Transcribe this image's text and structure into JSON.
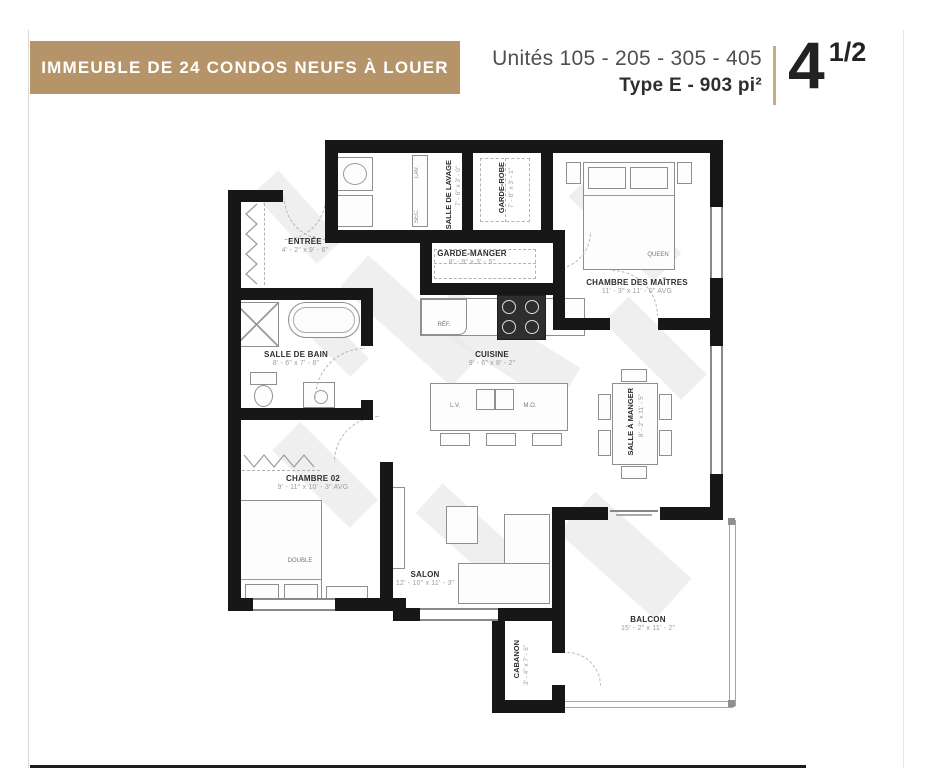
{
  "header": {
    "banner": "IMMEUBLE DE 24 CONDOS NEUFS À LOUER",
    "units_line": "Unités 105 - 205 - 305 - 405",
    "type_line": "Type E - 903 pi²",
    "size_main": "4",
    "size_fraction": "1/2",
    "banner_color": "#b5946a",
    "divider_color": "#c9ab80"
  },
  "rooms": {
    "entree": {
      "name": "ENTRÉE",
      "dims": "4' - 2\" x 9' - 6\""
    },
    "salle_de_lavage": {
      "name": "SALLE DE LAVAGE",
      "dims": "7' - 6\" x 3' - 0\""
    },
    "garde_robe": {
      "name": "GARDE-ROBE",
      "dims": "7' - 8\" x 3' - 1\""
    },
    "garde_manger": {
      "name": "GARDE-MANGER",
      "dims": "8' - 9\" x 3' - 5\""
    },
    "chambre_maitres": {
      "name": "CHAMBRE DES MAÎTRES",
      "dims": "11' - 3\" x 11' - 0\" AVG"
    },
    "salle_de_bain": {
      "name": "SALLE DE BAIN",
      "dims": "8' - 6\" x 7' - 8\""
    },
    "cuisine": {
      "name": "CUISINE",
      "dims": "9' - 6\" x 8' - 2\""
    },
    "salle_a_manger": {
      "name": "SALLE À MANGER",
      "dims": "8' - 2\" x 11' - 5\""
    },
    "chambre02": {
      "name": "CHAMBRE 02",
      "dims": "9' - 11\" x 10' - 3\" AVG"
    },
    "salon": {
      "name": "SALON",
      "dims": "12' - 10\" x 11' - 3\""
    },
    "cabanon": {
      "name": "CABANON",
      "dims": "3' - 4\" x 7' - 6\""
    },
    "balcon": {
      "name": "BALCON",
      "dims": "15' - 2\" x 11' - 2\""
    }
  },
  "furniture": {
    "queen": "QUEEN",
    "double": "DOUBLE",
    "fridge": "RÉF.",
    "dishwasher": "L.V.",
    "microwave": "M.O.",
    "washer": "LAV.",
    "dryer": "SEC."
  }
}
